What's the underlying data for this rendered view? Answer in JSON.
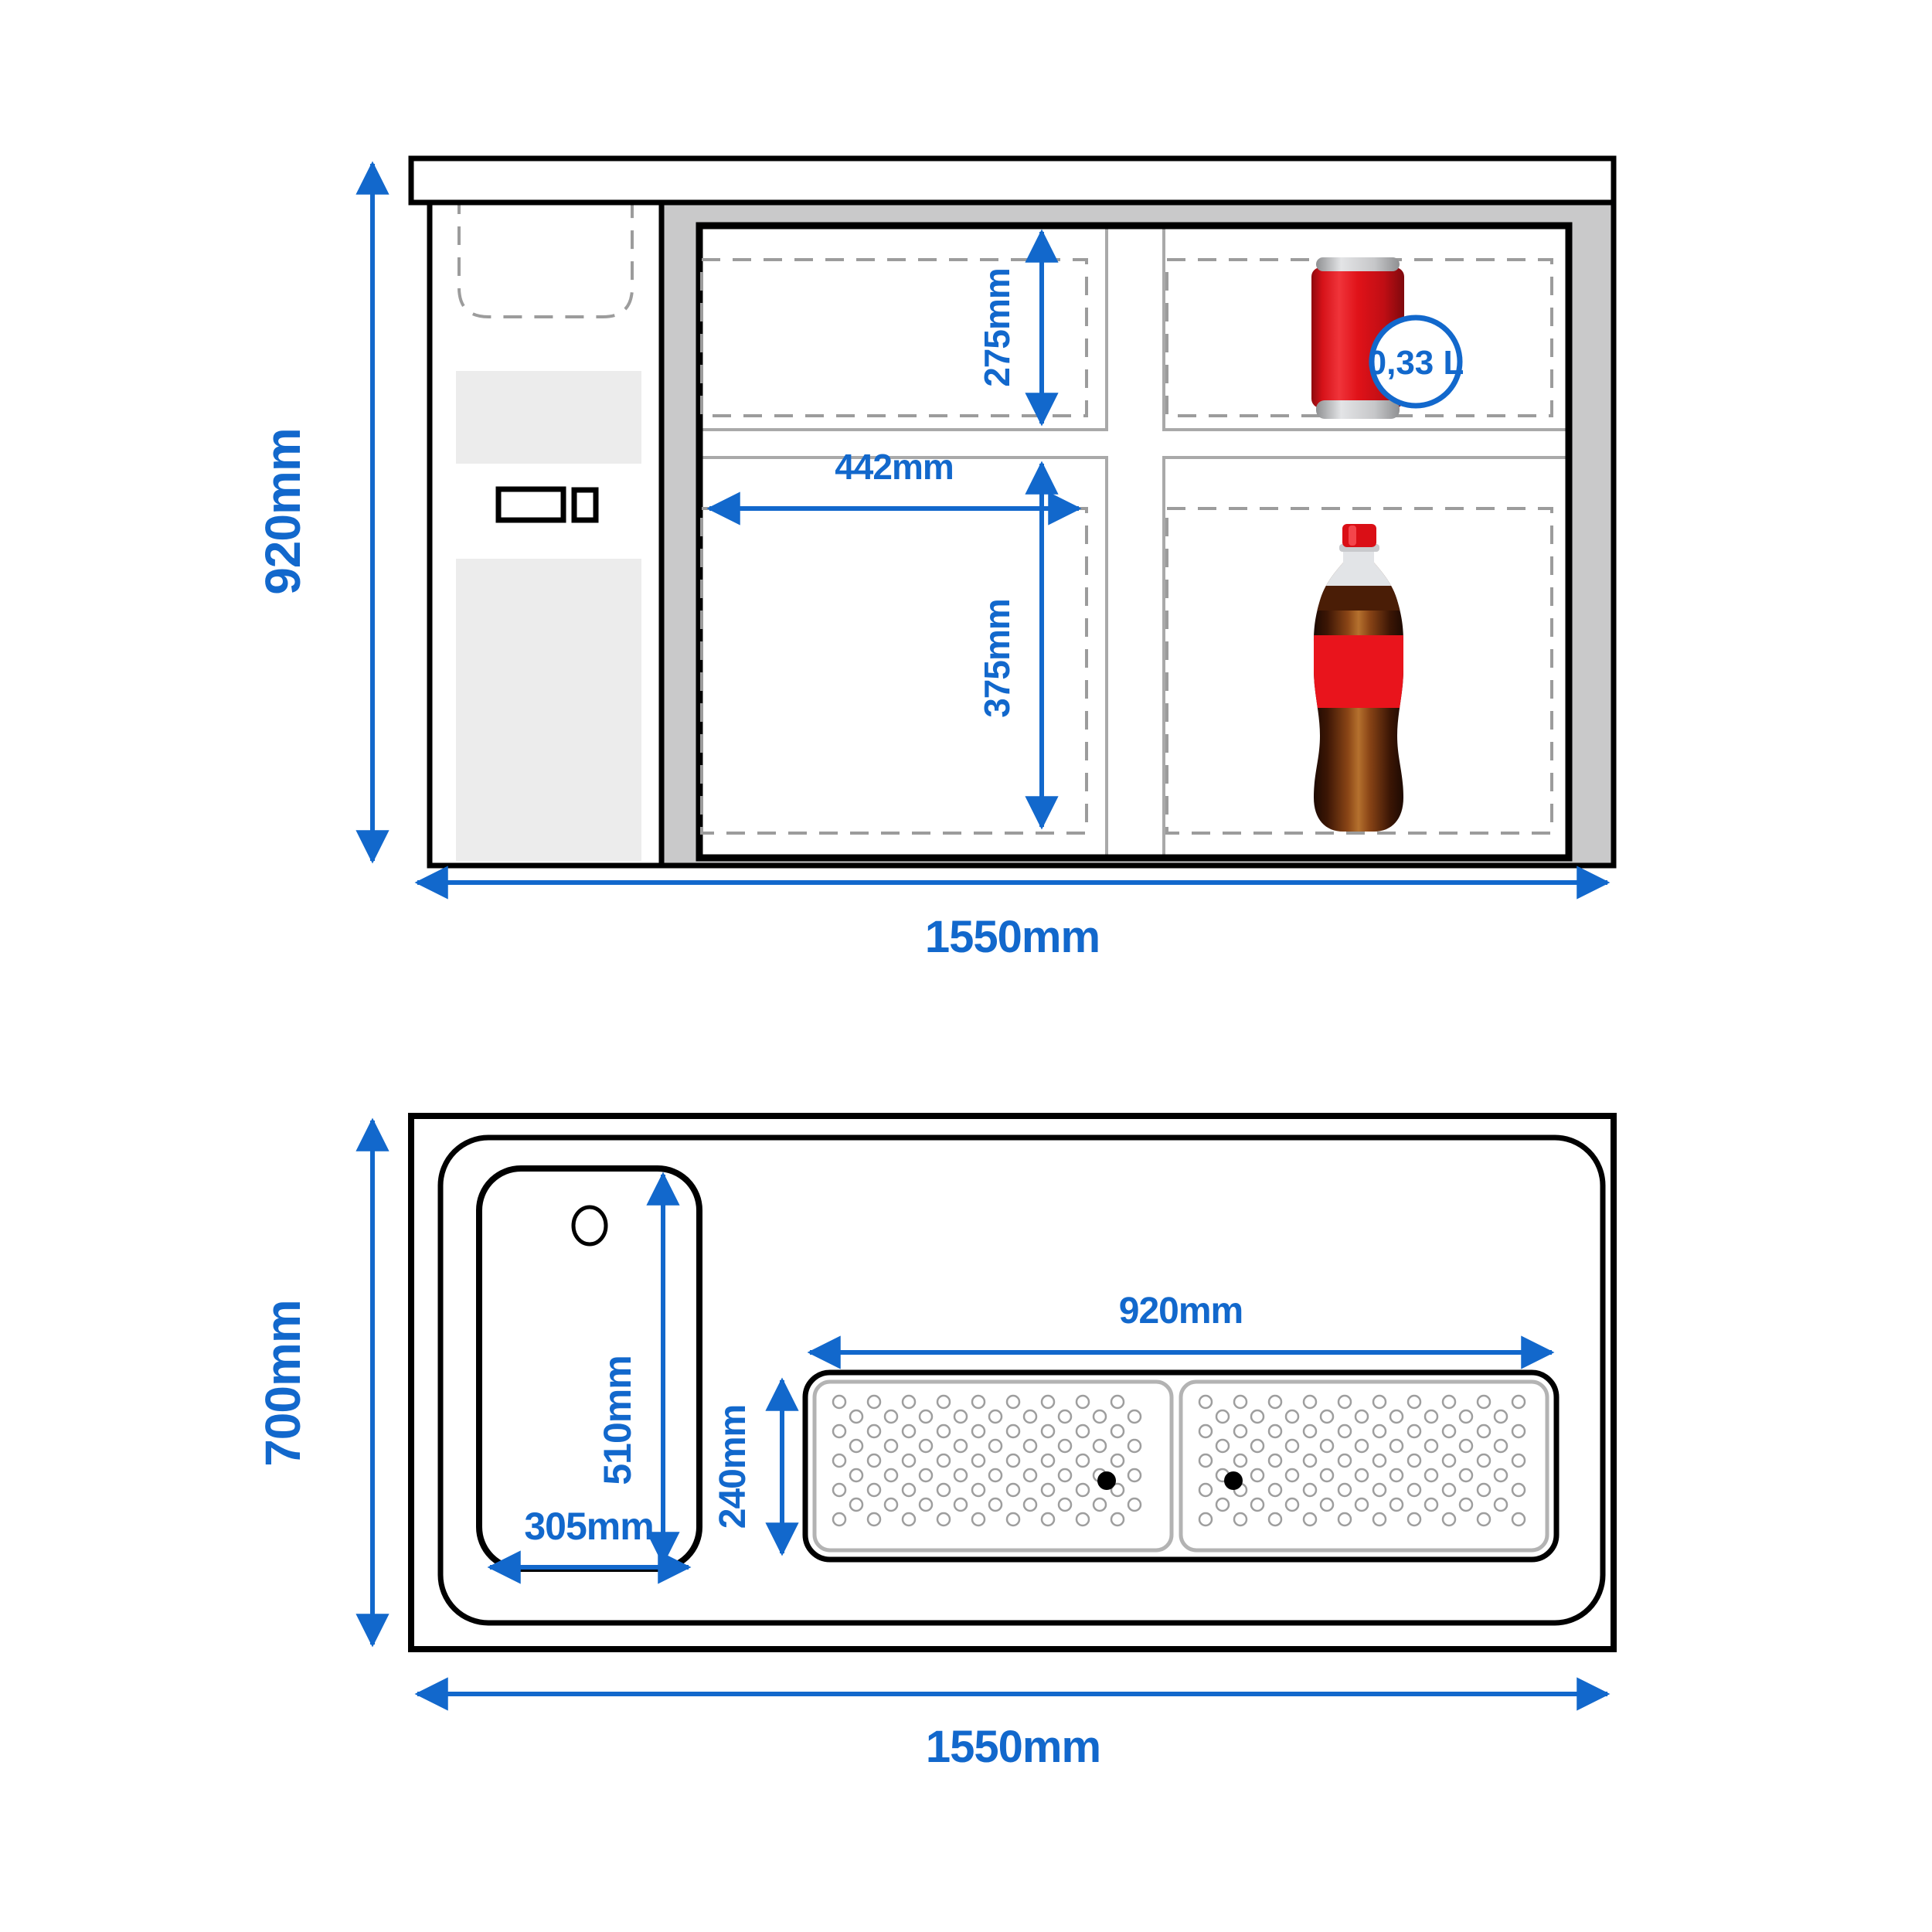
{
  "figure": "bar-counter-cooler-technical-drawing",
  "colors": {
    "dimension_blue": "#1268cc",
    "outline_black": "#000000",
    "body_gray": "#c9c9ca",
    "panel_light_gray": "#ececec",
    "dash_gray": "#9c9c9c",
    "divider_gray": "#a9a9a9",
    "drainer_border_gray": "#b3b3b3",
    "hole_gray": "#9e9e9e",
    "can_red": "#e01219",
    "bottle_label_red": "#e9141c",
    "silver": "#c6c7c9"
  },
  "front_view": {
    "overall_height": "920mm",
    "overall_width": "1550mm",
    "upper_compartment_height": "275mm",
    "compartment_width": "442mm",
    "lower_compartment_height": "375mm",
    "can_capacity": "0,33 L"
  },
  "top_view": {
    "overall_depth": "700mm",
    "overall_width": "1550mm",
    "sink_length": "510mm",
    "sink_width": "305mm",
    "drainer_width": "920mm",
    "drainer_depth": "240mm"
  }
}
